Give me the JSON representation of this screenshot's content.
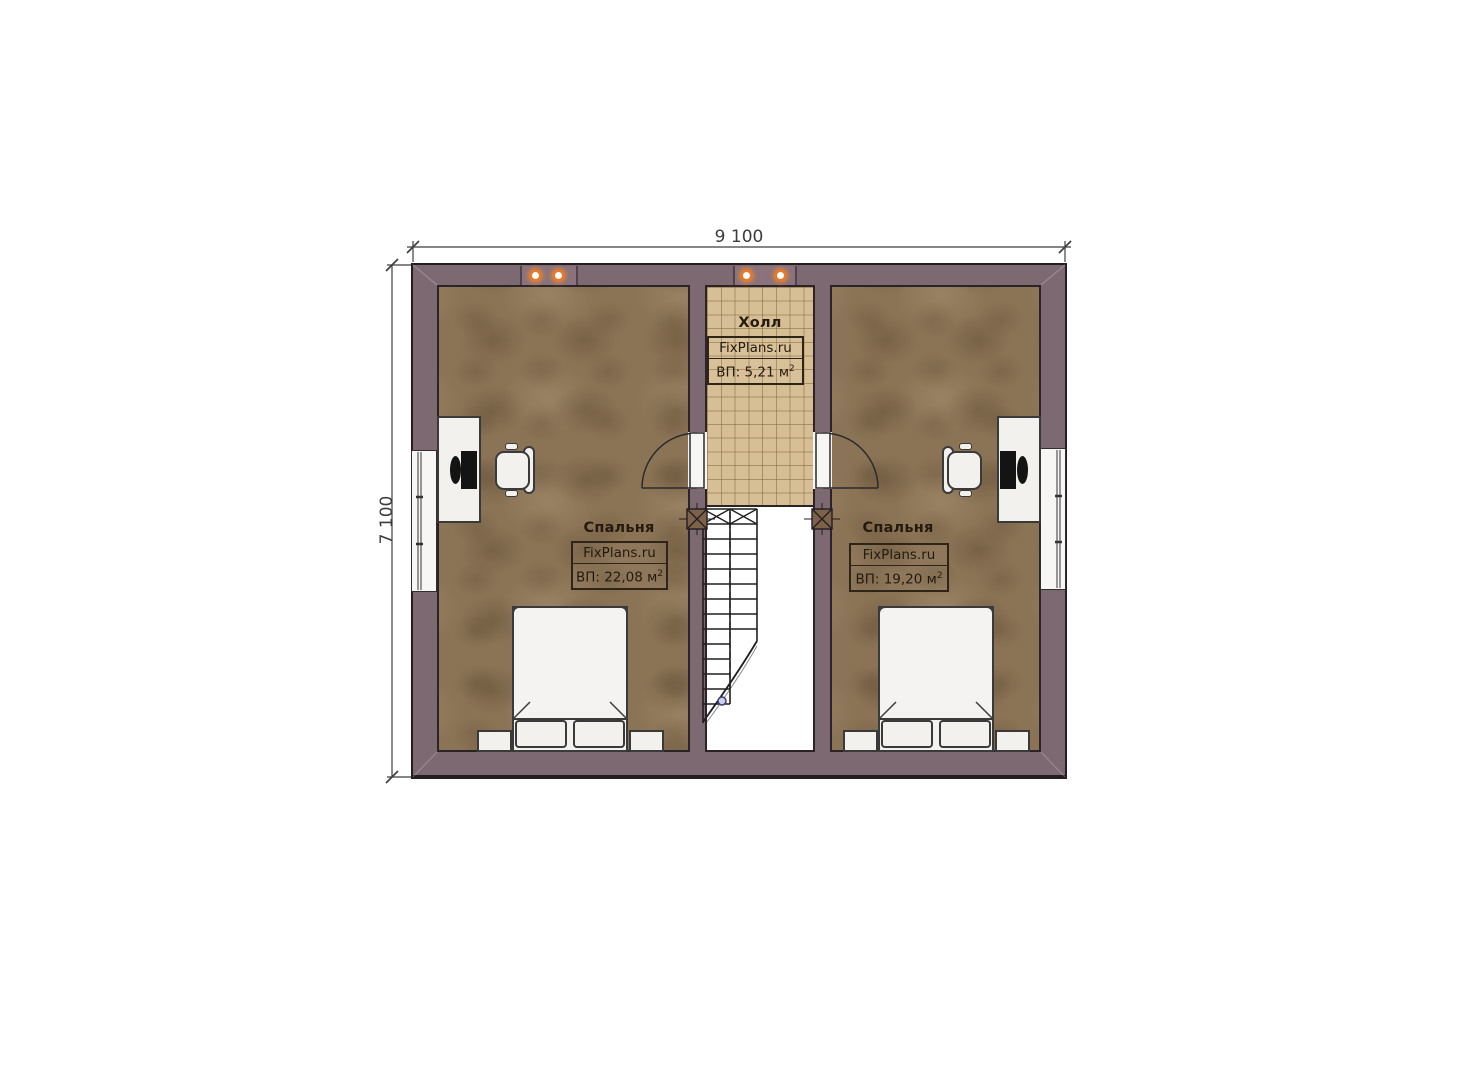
{
  "colors": {
    "wall": "#7d6971",
    "wall-panel": "#8a737c",
    "outline": "#241d21",
    "floor-line": "#2b2328",
    "bedroom-floor": "#8b7355",
    "hall-floor": "#d7bf95",
    "stairwell-floor": "#ffffff",
    "furniture": "#f2f1ee",
    "furniture-outline": "#3a3a3a",
    "screen": "#141414",
    "light-ring": "#e5792c",
    "dim-color": "#3c3c3c",
    "label-color": "#241a0e"
  },
  "dimensions": {
    "width_label": "9 100",
    "height_label": "7 100"
  },
  "rooms": {
    "hall": {
      "name": "Холл",
      "brand": "FixPlans.ru",
      "area": "ВП: 5,21 м",
      "area_sup": "2"
    },
    "bedroom_left": {
      "name": "Спальня",
      "brand": "FixPlans.ru",
      "area": "ВП: 22,08 м",
      "area_sup": "2"
    },
    "bedroom_right": {
      "name": "Спальня",
      "brand": "FixPlans.ru",
      "area": "ВП: 19,20 м",
      "area_sup": "2"
    }
  }
}
